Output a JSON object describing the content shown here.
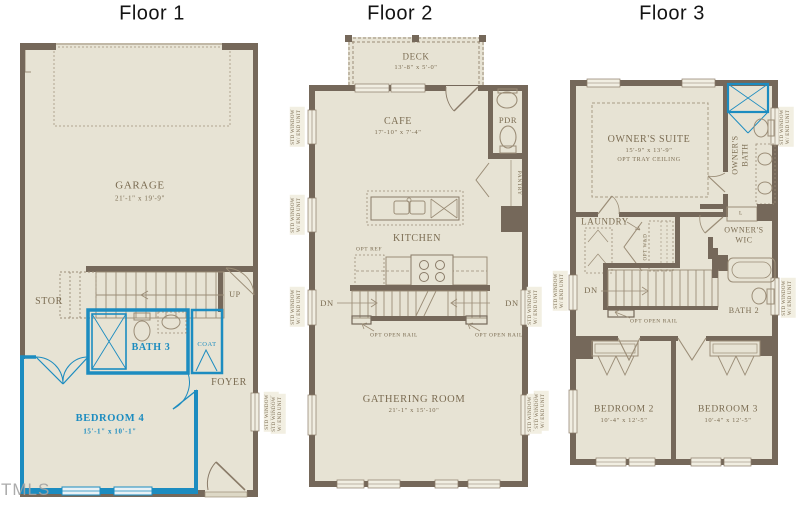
{
  "watermark": "TMLS",
  "colors": {
    "wall": "#75685a",
    "floor": "#e7e3d4",
    "accent_blue": "#1c8cc0",
    "label_brown": "#7b6c52"
  },
  "window_label": {
    "line1": "STD WINDOW",
    "line2": "W/ END UNIT"
  },
  "floor1": {
    "title": "Floor 1",
    "garage": {
      "name": "GARAGE",
      "dims": "21'-1\" x 19'-9\""
    },
    "stor": "STOR",
    "up": "UP",
    "bath3": "BATH 3",
    "coat": "COAT",
    "foyer": "FOYER",
    "bedroom4": {
      "name": "BEDROOM 4",
      "dims": "15'-1\" x 10'-1\""
    }
  },
  "floor2": {
    "title": "Floor 2",
    "deck": {
      "name": "DECK",
      "dims": "13'-8\" x 5'-0\""
    },
    "cafe": {
      "name": "CAFE",
      "dims": "17'-10\" x 7'-4\""
    },
    "pdr": "PDR",
    "pantry": "PANTRY",
    "kitchen": "KITCHEN",
    "opt_ref": "OPT REF",
    "dn": "DN",
    "opt_open_rail": "OPT OPEN RAIL",
    "gathering": {
      "name": "GATHERING ROOM",
      "dims": "21'-1\" x 15'-10\""
    }
  },
  "floor3": {
    "title": "Floor 3",
    "owners_suite": {
      "name": "OWNER'S SUITE",
      "dims": "15'-9\" x 13'-9\"",
      "note": "OPT TRAY CEILING"
    },
    "owners_bath": {
      "line1": "OWNER'S",
      "line2": "BATH"
    },
    "owners_wic": {
      "line1": "OWNER'S",
      "line2": "WIC"
    },
    "laundry": "LAUNDRY",
    "opt_wd": "OPT W&D",
    "linen": "L",
    "dn": "DN",
    "opt_open_rail": "OPT OPEN RAIL",
    "bath2": "BATH 2",
    "bedroom2": {
      "name": "BEDROOM 2",
      "dims": "10'-4\" x 12'-5\""
    },
    "bedroom3": {
      "name": "BEDROOM 3",
      "dims": "10'-4\" x 12'-5\""
    }
  }
}
